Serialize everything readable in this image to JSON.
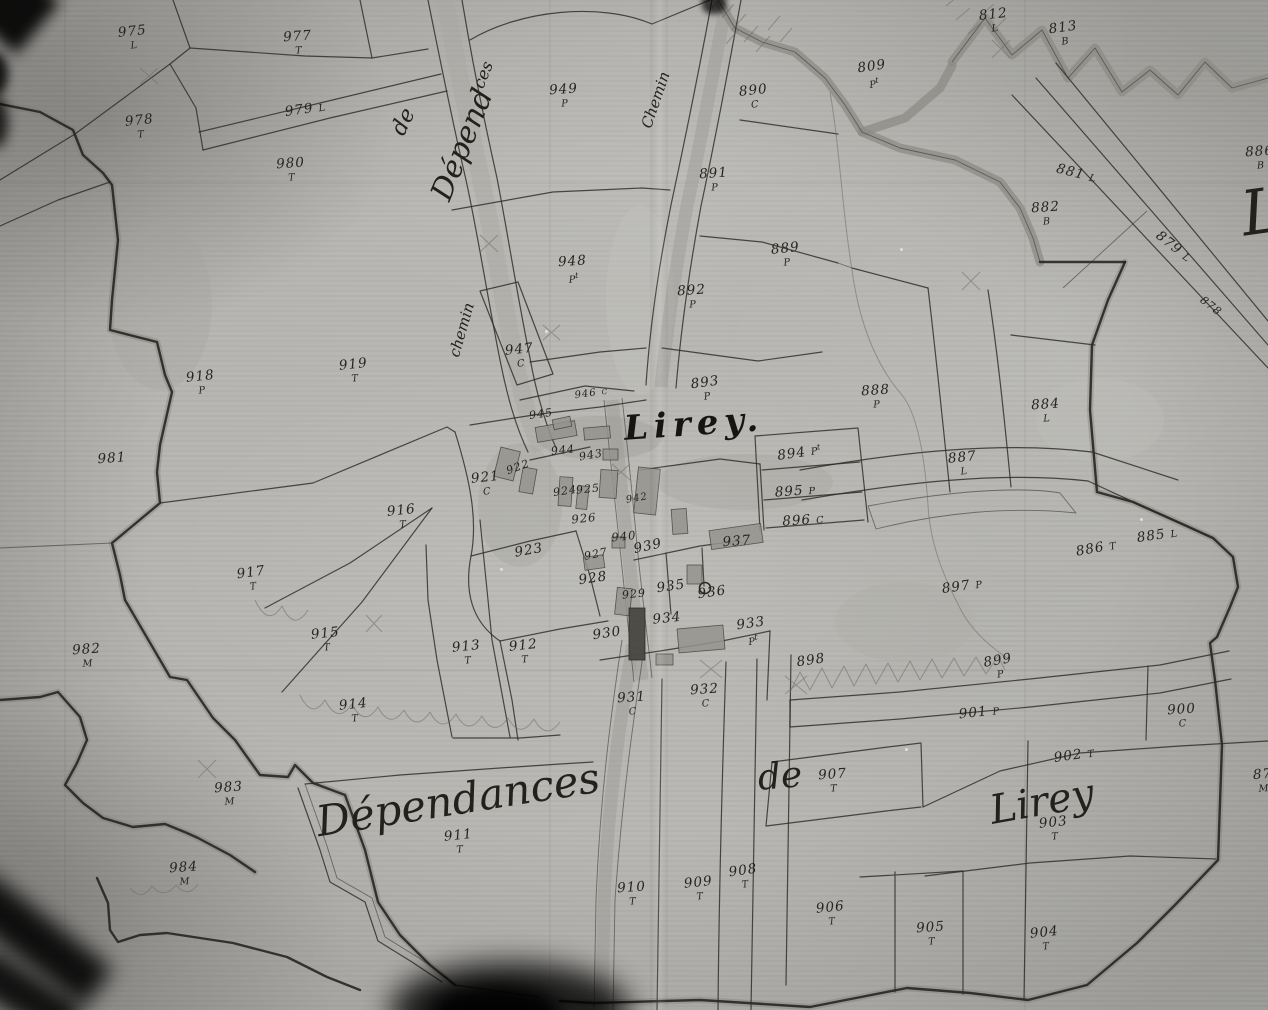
{
  "map_title": {
    "text": "Lirey."
  },
  "colors": {
    "paper": "#b6b5b1",
    "ink": "#26241f",
    "band_gray": "#8d8b85",
    "building_gray": "#96948e",
    "building_dark": "#4a4843"
  },
  "script_labels": [
    {
      "id": "dependances-road",
      "text": "Dépend",
      "sup": "ces",
      "x": 468,
      "y": 132,
      "rot": -68,
      "fs": 30,
      "kind": "script"
    },
    {
      "id": "de-road",
      "text": "de",
      "sup": "",
      "x": 404,
      "y": 122,
      "rot": -64,
      "fs": 22,
      "kind": "script"
    },
    {
      "id": "chemin-west",
      "text": "chemin",
      "sup": "",
      "x": 462,
      "y": 330,
      "rot": -74,
      "fs": 15,
      "kind": "script"
    },
    {
      "id": "chemin-north",
      "text": "Chemin",
      "sup": "",
      "x": 656,
      "y": 100,
      "rot": -71,
      "fs": 15,
      "kind": "script"
    },
    {
      "id": "village-title",
      "text": "Lirey.",
      "sup": "",
      "x": 694,
      "y": 424,
      "rot": -4,
      "fs": 34,
      "kind": "title"
    },
    {
      "id": "dependances-south",
      "text": "Dépendances",
      "sup": "",
      "x": 458,
      "y": 800,
      "rot": -9,
      "fs": 42,
      "kind": "script"
    },
    {
      "id": "de-south",
      "text": "de",
      "sup": "",
      "x": 780,
      "y": 777,
      "rot": -5,
      "fs": 36,
      "kind": "script"
    },
    {
      "id": "lirey-south",
      "text": "Lirey",
      "sup": "",
      "x": 1042,
      "y": 802,
      "rot": -10,
      "fs": 40,
      "kind": "script"
    },
    {
      "id": "flourish-edge",
      "text": "L",
      "sup": "",
      "x": 1262,
      "y": 212,
      "rot": -8,
      "fs": 62,
      "kind": "script"
    }
  ],
  "parcels": [
    {
      "n": "975",
      "s": "L",
      "x": 133,
      "y": 38,
      "rot": -6
    },
    {
      "n": "977",
      "s": "T",
      "x": 298,
      "y": 43,
      "rot": -4
    },
    {
      "n": "978",
      "s": "T",
      "x": 140,
      "y": 127,
      "rot": -6
    },
    {
      "n": "979",
      "s": "L",
      "x": 305,
      "y": 110,
      "rot": -8,
      "inline": true
    },
    {
      "n": "980",
      "s": "T",
      "x": 291,
      "y": 170,
      "rot": -4
    },
    {
      "n": "949",
      "s": "P",
      "x": 564,
      "y": 96,
      "rot": -4
    },
    {
      "n": "890",
      "s": "C",
      "x": 754,
      "y": 97,
      "rot": -6
    },
    {
      "n": "809",
      "s": "Pt",
      "x": 873,
      "y": 75,
      "rot": -8
    },
    {
      "n": "812",
      "s": "L",
      "x": 994,
      "y": 21,
      "rot": -6
    },
    {
      "n": "813",
      "s": "B",
      "x": 1064,
      "y": 34,
      "rot": -8
    },
    {
      "n": "891",
      "s": "P",
      "x": 714,
      "y": 180,
      "rot": -4
    },
    {
      "n": "881",
      "s": "L",
      "x": 1076,
      "y": 174,
      "rot": 14,
      "inline": true
    },
    {
      "n": "882",
      "s": "B",
      "x": 1046,
      "y": 214,
      "rot": -4
    },
    {
      "n": "879",
      "s": "L",
      "x": 1173,
      "y": 247,
      "rot": 38,
      "inline": true
    },
    {
      "n": "878",
      "s": "",
      "x": 1211,
      "y": 306,
      "rot": 38,
      "fs": 11
    },
    {
      "n": "886",
      "s": "B",
      "x": 1260,
      "y": 158,
      "rot": -4
    },
    {
      "n": "889",
      "s": "P",
      "x": 786,
      "y": 255,
      "rot": -6
    },
    {
      "n": "892",
      "s": "P",
      "x": 692,
      "y": 297,
      "rot": -4
    },
    {
      "n": "948",
      "s": "Pt",
      "x": 573,
      "y": 270,
      "rot": -4
    },
    {
      "n": "947",
      "s": "C",
      "x": 520,
      "y": 356,
      "rot": -6
    },
    {
      "n": "918",
      "s": "P",
      "x": 201,
      "y": 383,
      "rot": -6
    },
    {
      "n": "919",
      "s": "T",
      "x": 354,
      "y": 371,
      "rot": -6
    },
    {
      "n": "981",
      "s": "",
      "x": 112,
      "y": 459,
      "rot": -4
    },
    {
      "n": "893",
      "s": "P",
      "x": 706,
      "y": 389,
      "rot": -8
    },
    {
      "n": "888",
      "s": "P",
      "x": 876,
      "y": 397,
      "rot": -4
    },
    {
      "n": "884",
      "s": "L",
      "x": 1046,
      "y": 411,
      "rot": -4
    },
    {
      "n": "887",
      "s": "L",
      "x": 963,
      "y": 464,
      "rot": -6
    },
    {
      "n": "885",
      "s": "L",
      "x": 1157,
      "y": 536,
      "rot": -8,
      "inline": true
    },
    {
      "n": "886",
      "s": "T",
      "x": 1096,
      "y": 549,
      "rot": -10,
      "inline": true
    },
    {
      "n": "894",
      "s": "Pt",
      "x": 799,
      "y": 453,
      "rot": -8,
      "inline": true
    },
    {
      "n": "895",
      "s": "P",
      "x": 795,
      "y": 492,
      "rot": -4,
      "inline": true
    },
    {
      "n": "896",
      "s": "C",
      "x": 803,
      "y": 521,
      "rot": -4,
      "inline": true
    },
    {
      "n": "937",
      "s": "",
      "x": 737,
      "y": 542,
      "rot": -4
    },
    {
      "n": "916",
      "s": "T",
      "x": 402,
      "y": 517,
      "rot": -6
    },
    {
      "n": "917",
      "s": "T",
      "x": 252,
      "y": 579,
      "rot": -8
    },
    {
      "n": "921",
      "s": "C",
      "x": 486,
      "y": 484,
      "rot": -6
    },
    {
      "n": "922",
      "s": "",
      "x": 518,
      "y": 467,
      "rot": -20,
      "fs": 11
    },
    {
      "n": "924",
      "s": "",
      "x": 565,
      "y": 491,
      "rot": -8,
      "fs": 11
    },
    {
      "n": "925",
      "s": "",
      "x": 588,
      "y": 489,
      "rot": -6,
      "fs": 11
    },
    {
      "n": "926",
      "s": "",
      "x": 584,
      "y": 519,
      "rot": -6,
      "fs": 11.5
    },
    {
      "n": "923",
      "s": "",
      "x": 529,
      "y": 551,
      "rot": -10
    },
    {
      "n": "927",
      "s": "",
      "x": 596,
      "y": 554,
      "rot": -12,
      "fs": 11
    },
    {
      "n": "928",
      "s": "",
      "x": 593,
      "y": 579,
      "rot": -8
    },
    {
      "n": "940",
      "s": "",
      "x": 624,
      "y": 537,
      "rot": -6,
      "fs": 11.5
    },
    {
      "n": "939",
      "s": "",
      "x": 648,
      "y": 547,
      "rot": -12
    },
    {
      "n": "942",
      "s": "",
      "x": 637,
      "y": 499,
      "rot": -10,
      "fs": 10
    },
    {
      "n": "929",
      "s": "",
      "x": 634,
      "y": 594,
      "rot": -6,
      "fs": 11
    },
    {
      "n": "935",
      "s": "",
      "x": 671,
      "y": 587,
      "rot": -8
    },
    {
      "n": "936",
      "s": "",
      "x": 712,
      "y": 593,
      "rot": -8
    },
    {
      "n": "934",
      "s": "",
      "x": 667,
      "y": 619,
      "rot": -6
    },
    {
      "n": "930",
      "s": "",
      "x": 607,
      "y": 634,
      "rot": -8
    },
    {
      "n": "933",
      "s": "Pt",
      "x": 752,
      "y": 632,
      "rot": -8
    },
    {
      "n": "898",
      "s": "",
      "x": 811,
      "y": 661,
      "rot": -8
    },
    {
      "n": "897",
      "s": "P",
      "x": 962,
      "y": 587,
      "rot": -8,
      "inline": true
    },
    {
      "n": "899",
      "s": "P",
      "x": 999,
      "y": 667,
      "rot": -10
    },
    {
      "n": "901",
      "s": "P",
      "x": 979,
      "y": 713,
      "rot": -6,
      "inline": true
    },
    {
      "n": "900",
      "s": "C",
      "x": 1182,
      "y": 716,
      "rot": -4
    },
    {
      "n": "902",
      "s": "T",
      "x": 1074,
      "y": 756,
      "rot": -8,
      "inline": true
    },
    {
      "n": "931",
      "s": "C",
      "x": 632,
      "y": 704,
      "rot": -4
    },
    {
      "n": "932",
      "s": "C",
      "x": 705,
      "y": 696,
      "rot": -4
    },
    {
      "n": "915",
      "s": "T",
      "x": 326,
      "y": 640,
      "rot": -6
    },
    {
      "n": "913",
      "s": "T",
      "x": 467,
      "y": 653,
      "rot": -6
    },
    {
      "n": "912",
      "s": "T",
      "x": 524,
      "y": 652,
      "rot": -6
    },
    {
      "n": "914",
      "s": "T",
      "x": 354,
      "y": 711,
      "rot": -6
    },
    {
      "n": "982",
      "s": "M",
      "x": 87,
      "y": 656,
      "rot": -4
    },
    {
      "n": "983",
      "s": "M",
      "x": 229,
      "y": 794,
      "rot": -4
    },
    {
      "n": "984",
      "s": "M",
      "x": 184,
      "y": 874,
      "rot": -4
    },
    {
      "n": "911",
      "s": "T",
      "x": 459,
      "y": 842,
      "rot": -6
    },
    {
      "n": "910",
      "s": "T",
      "x": 632,
      "y": 894,
      "rot": -4
    },
    {
      "n": "909",
      "s": "T",
      "x": 699,
      "y": 889,
      "rot": -6
    },
    {
      "n": "908",
      "s": "T",
      "x": 744,
      "y": 877,
      "rot": -8
    },
    {
      "n": "907",
      "s": "T",
      "x": 833,
      "y": 781,
      "rot": -4
    },
    {
      "n": "906",
      "s": "T",
      "x": 831,
      "y": 914,
      "rot": -6
    },
    {
      "n": "905",
      "s": "T",
      "x": 931,
      "y": 934,
      "rot": -4
    },
    {
      "n": "904",
      "s": "T",
      "x": 1045,
      "y": 939,
      "rot": -6
    },
    {
      "n": "903",
      "s": "T",
      "x": 1054,
      "y": 829,
      "rot": -6
    },
    {
      "n": "945",
      "s": "",
      "x": 541,
      "y": 414,
      "rot": -8,
      "fs": 11
    },
    {
      "n": "944",
      "s": "",
      "x": 563,
      "y": 450,
      "rot": -6,
      "fs": 11
    },
    {
      "n": "943",
      "s": "",
      "x": 591,
      "y": 455,
      "rot": -10,
      "fs": 11
    },
    {
      "n": "946",
      "s": "C",
      "x": 591,
      "y": 394,
      "rot": -8,
      "fs": 10,
      "inline": true
    },
    {
      "n": "87",
      "s": "M",
      "x": 1263,
      "y": 781,
      "rot": -4
    }
  ]
}
